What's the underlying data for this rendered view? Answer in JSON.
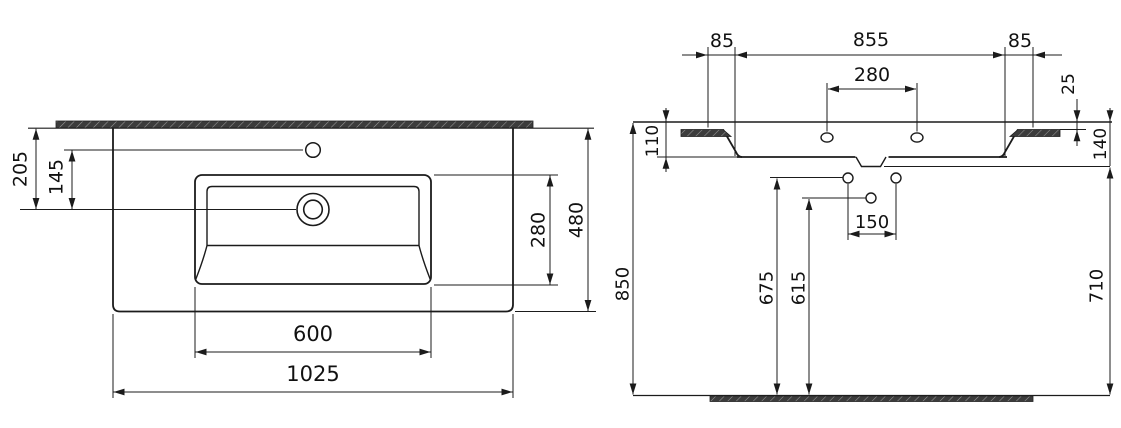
{
  "drawing": {
    "type": "technical-dimension-drawing",
    "subject": "wall-hung washbasin, plan view (left) and front elevation (right)",
    "line_color": "#1b1b1b",
    "background": "#ffffff",
    "hatch_fill": "#3c3c3c"
  },
  "plan": {
    "total_width": "1025",
    "basin_width": "600",
    "total_depth": "480",
    "basin_depth": "280",
    "wall_to_drain": "205",
    "faucet_to_drain": "145"
  },
  "front": {
    "edge_to_bracket_left": "85",
    "bracket_spacing": "855",
    "edge_to_bracket_right": "85",
    "fixing_hole_spacing": "280",
    "rim_to_bracket": "25",
    "rear_height": "110",
    "front_height": "140",
    "rim_to_floor": "850",
    "outlet_left_to_floor": "675",
    "outlet_mid_to_floor": "615",
    "outlet_spacing": "150",
    "underside_to_floor": "710"
  }
}
